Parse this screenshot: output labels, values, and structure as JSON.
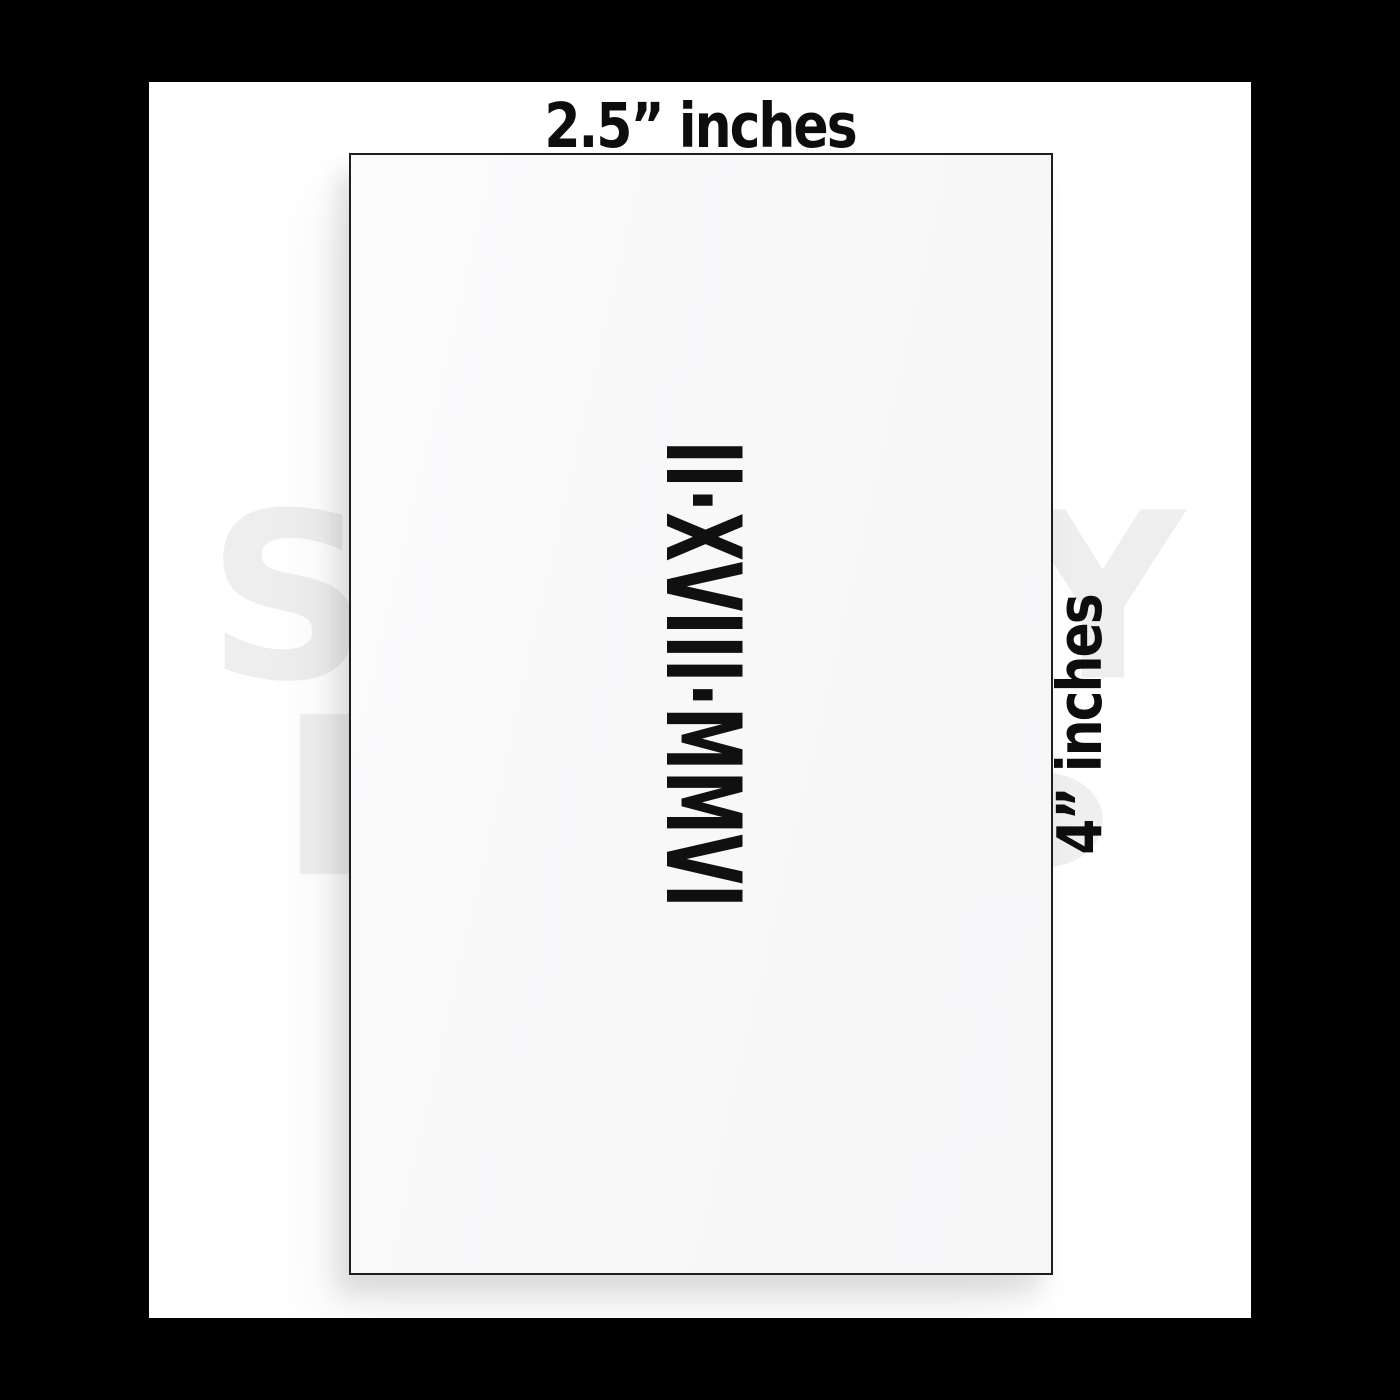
{
  "frame": {
    "outer_background": "#000000",
    "inner_background": "#ffffff"
  },
  "dimension_labels": {
    "top": "2.5” inches",
    "right": "4” inches",
    "text_color": "#0d0d0d"
  },
  "card": {
    "date_text": "II·XVIII·MMVI",
    "text_color": "#101010",
    "background": "#f8f8f9",
    "border_color": "#1e1e1e"
  },
  "watermark": {
    "color": "#eeeeee",
    "letter_left": "S",
    "letter_right": "Y"
  }
}
